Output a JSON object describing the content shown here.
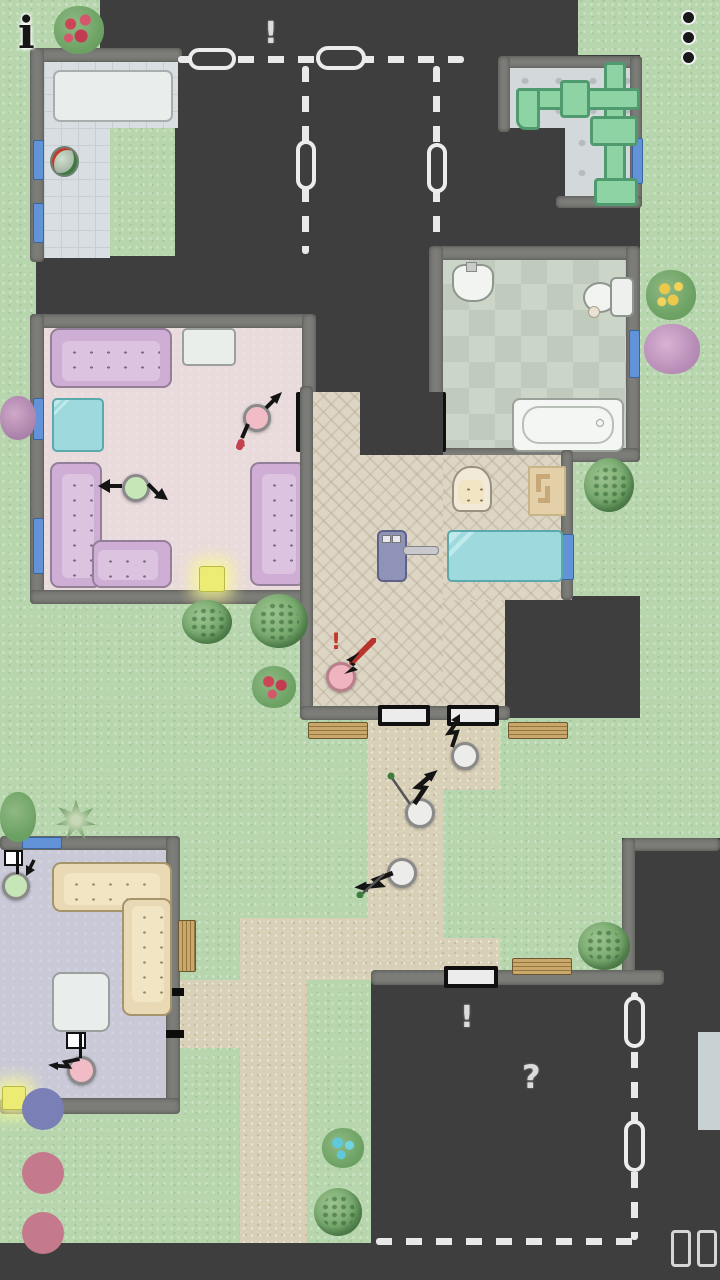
{
  "hud": {
    "info_button": {
      "icon": "info-icon",
      "glyph": "i"
    },
    "menu_button": {
      "icon": "kebab-menu-icon",
      "dot_count": 3
    },
    "pause_button": {
      "icon": "pause-icon"
    }
  },
  "markers": {
    "planned_rooms_alert": {
      "glyph": "!",
      "color": "#ececec"
    },
    "locked_house_alert": {
      "glyph": "!",
      "color": "#d8d8d8"
    },
    "locked_house_question": {
      "glyph": "?",
      "color": "#d8d8d8"
    },
    "worker_alert": {
      "glyph": "!",
      "color": "#c0392b"
    }
  },
  "palette": {
    "grass": "#b7d6ae",
    "path": "#d9d0b8",
    "unexplored_roof": "#3e3e3e",
    "wall": "#7c7c78",
    "living_floor": "#e9dadc",
    "lounge_floor": "#c9c9d8",
    "bathroom_floor": "#ccd6c8",
    "patio_floor": "#ded6c5",
    "bedroom_tile": "#d8dee1",
    "pipe_green": "#8ed3a4",
    "window_blue": "#6292d8",
    "sofa_purple": "#cfaed6",
    "sofa_cream": "#ead9b5",
    "glass_cyan": "#9ed9dd",
    "light_yellow": "#ecec74",
    "char_pink": "#f2bcc6",
    "char_green": "#c7e6b8",
    "char_gray": "#ececea",
    "beanbag_blue": "#7a7fb5",
    "pouf_rose": "#c4798c",
    "accent_red": "#b8342c"
  },
  "rooms": [
    {
      "id": "bedroom-nw",
      "floor": "gray-tile",
      "items": [
        "white-bed",
        "planter-pot",
        "windows"
      ]
    },
    {
      "id": "planned-rooms",
      "state": "unbuilt-dashed",
      "doors_planned": 4
    },
    {
      "id": "utility-room",
      "floor": "stone",
      "items": [
        "green-pipes",
        "window"
      ]
    },
    {
      "id": "bathroom",
      "floor": "green-checker",
      "items": [
        "sink",
        "toilet",
        "bathtub",
        "door",
        "window"
      ]
    },
    {
      "id": "living-room",
      "floor": "pink",
      "items": [
        "sofa-3seat",
        "tv-table",
        "glass-table",
        "corner-sofa",
        "sofa-2seat",
        "floor-light",
        "door",
        "windows"
      ]
    },
    {
      "id": "patio",
      "floor": "herringbone",
      "items": [
        "armchair",
        "rug",
        "long-glass-table",
        "exercise-machine",
        "door-1",
        "door-2",
        "window"
      ]
    },
    {
      "id": "lounge-sw",
      "floor": "lavender",
      "items": [
        "corner-sofa-cream",
        "side-table",
        "floor-light",
        "bean-bag",
        "window"
      ]
    },
    {
      "id": "locked-house-se",
      "state": "unexplored",
      "markers": [
        "!",
        "?"
      ],
      "door": "white"
    },
    {
      "id": "locked-house-e",
      "state": "unexplored"
    }
  ],
  "characters": [
    {
      "id": "resident-green-living",
      "color": "#c7e6b8",
      "indicator": "flail-arrows"
    },
    {
      "id": "resident-pink-living",
      "color": "#f2bcc6",
      "indicator": "arrow-ne",
      "carrying": "red-item"
    },
    {
      "id": "worker-pink-patio",
      "color": "#f0b4be",
      "indicator": "red-alert",
      "carrying": "red-tool"
    },
    {
      "id": "visitor-gray-1",
      "color": "#ececea",
      "indicator": "zigzag-arrow"
    },
    {
      "id": "visitor-gray-2",
      "color": "#ececea",
      "indicator": "zigzag-arrow",
      "carrying": "green-sprout"
    },
    {
      "id": "visitor-gray-3",
      "color": "#ececea",
      "indicator": "zigzag-arrow",
      "carrying": "green-sprout"
    },
    {
      "id": "resident-green-lounge",
      "color": "#c7e6b8",
      "indicator": "white-flag"
    },
    {
      "id": "resident-pink-lounge",
      "color": "#f2bcc6",
      "indicator": "white-flag"
    }
  ],
  "outdoor": {
    "benches": 4,
    "poufs": [
      "blue-bean-bag",
      "rose-pouf",
      "rose-pouf"
    ],
    "plants": [
      "red-flower-bush-nw",
      "purple-bush-w",
      "red-flower-bush-c",
      "yellow-flower-bush-e",
      "purple-bush-e",
      "tree-pair-c",
      "tree-e",
      "star-plant-sw",
      "bush-sw",
      "tree-pair-se",
      "blue-flower-bush-s",
      "tree-s"
    ]
  }
}
